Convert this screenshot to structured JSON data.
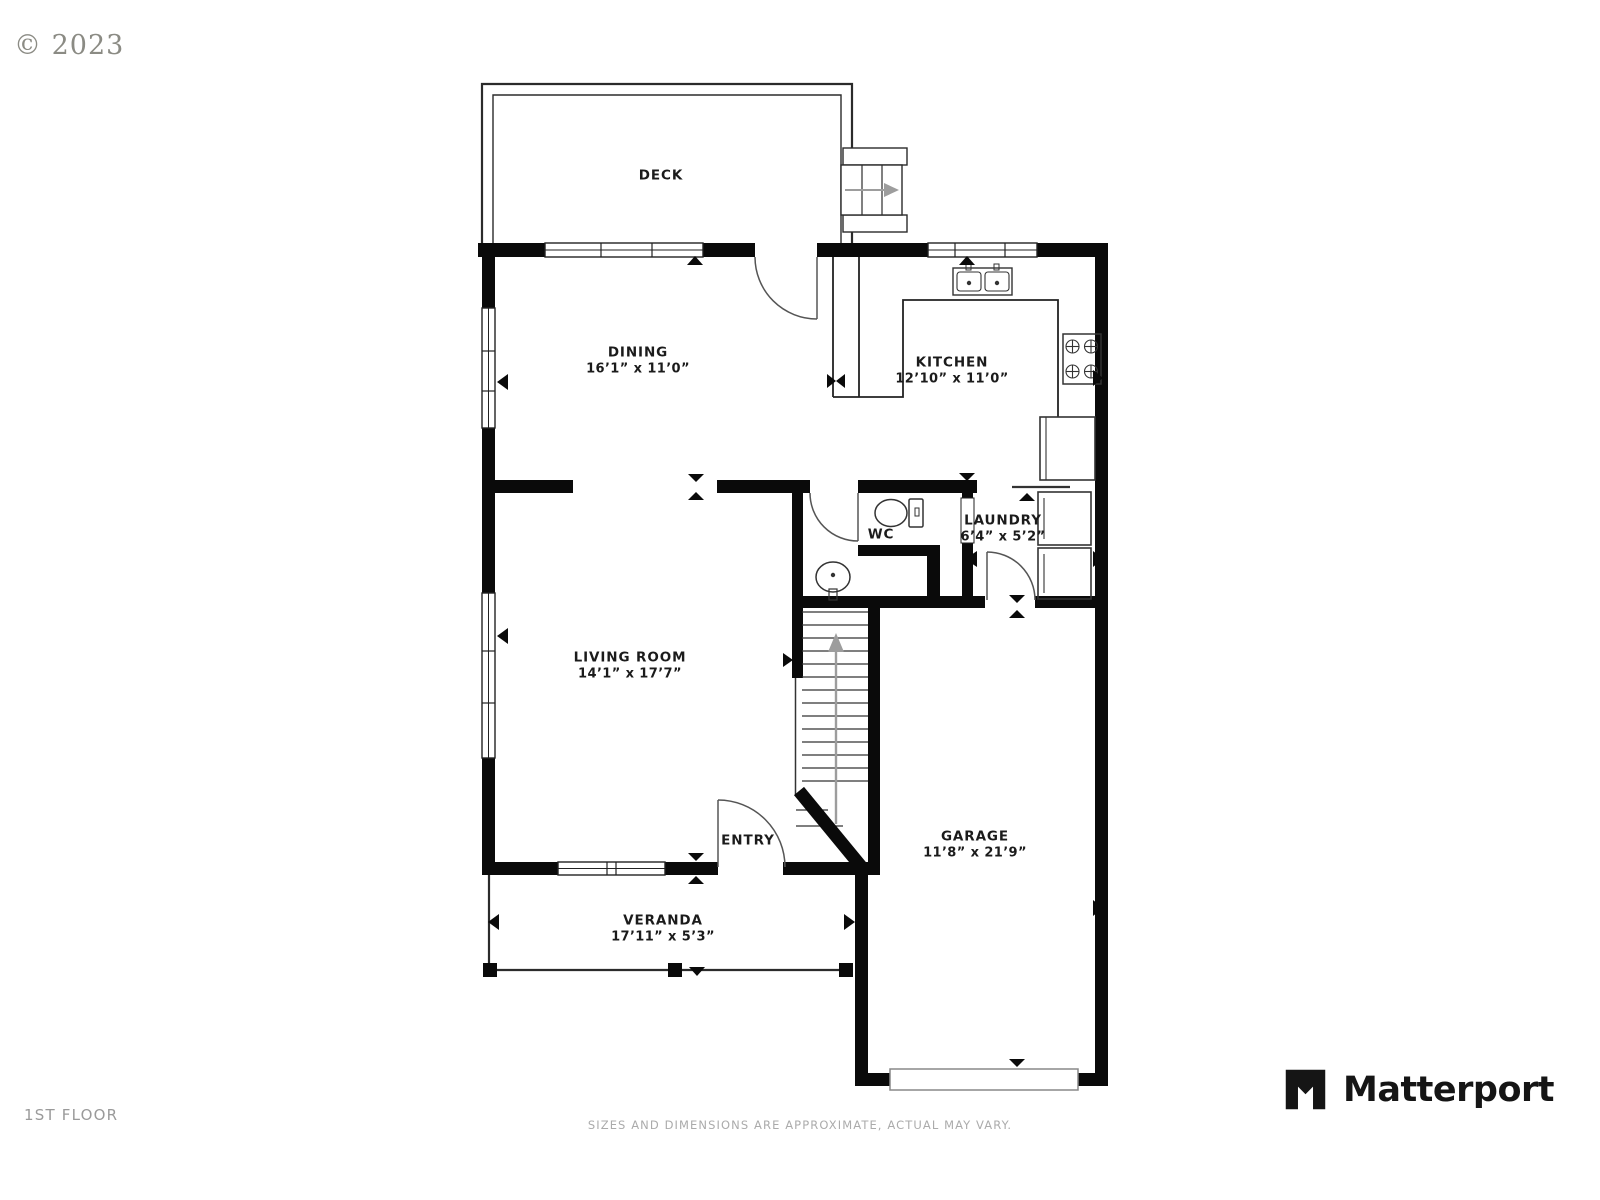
{
  "page": {
    "copyright": "© 2023",
    "floor_label": "1ST FLOOR",
    "disclaimer": "SIZES AND DIMENSIONS ARE APPROXIMATE, ACTUAL MAY VARY.",
    "brand": "Matterport"
  },
  "rooms": {
    "deck": {
      "name": "DECK"
    },
    "dining": {
      "name": "DINING",
      "dims": "16’1” x 11’0”"
    },
    "kitchen": {
      "name": "KITCHEN",
      "dims": "12’10” x 11’0”"
    },
    "wc": {
      "name": "WC"
    },
    "laundry": {
      "name": "LAUNDRY",
      "dims": "6’4” x 5’2”"
    },
    "living": {
      "name": "LIVING ROOM",
      "dims": "14’1” x 17’7”"
    },
    "entry": {
      "name": "ENTRY"
    },
    "garage": {
      "name": "GARAGE",
      "dims": "11’8” x 21’9”"
    },
    "veranda": {
      "name": "VERANDA",
      "dims": "17’11” x 5’3”"
    }
  },
  "colors": {
    "wall": "#0a0a0a",
    "thin_line": "#2b2b2b",
    "door_arc": "#555555",
    "stair_arrow": "#9d9d9d",
    "label_text": "#1b1b1b",
    "muted_text": "#9a9a9a",
    "brand_text": "#151515"
  }
}
